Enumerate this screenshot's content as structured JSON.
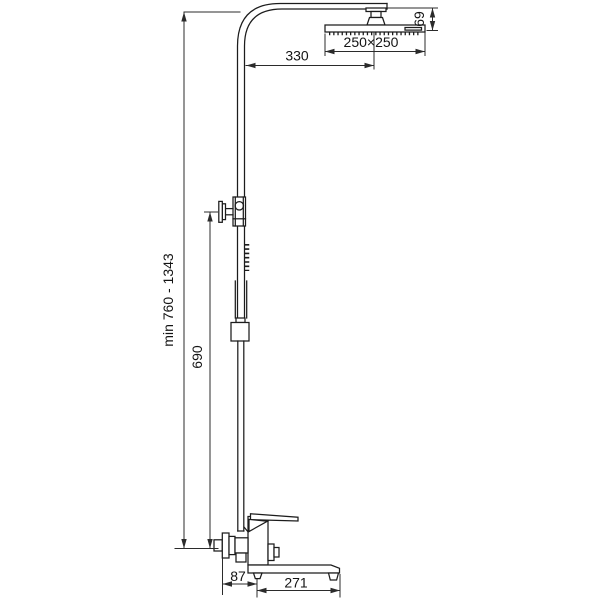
{
  "drawing": {
    "type": "technical-dimension-drawing",
    "subject": "shower-column-with-rain-head-and-bath-mixer",
    "colors": {
      "background": "#ffffff",
      "product_line": "#1c1c1c",
      "dimension_line": "#2b2b2b",
      "text": "#141414"
    },
    "dimensions": {
      "arm_length": "330",
      "head_size": "250×250",
      "head_height": "69",
      "total_height": "min 760 - 1343",
      "rail_height": "690",
      "spout_offset": "87",
      "spout_length": "271"
    }
  }
}
